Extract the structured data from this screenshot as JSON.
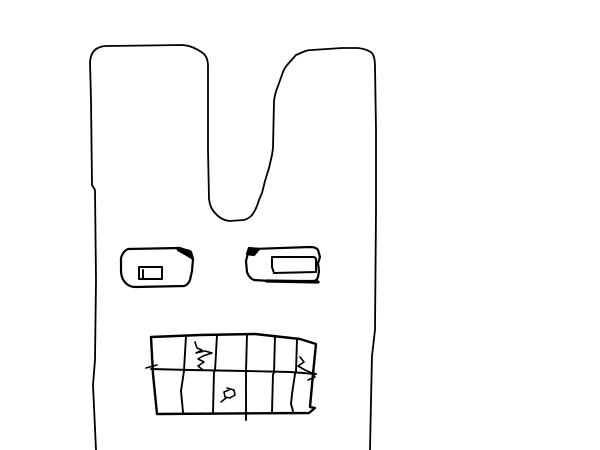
{
  "artwork": {
    "description": "Hand-drawn black-on-white paint doodle of a face with two tall ears, two rectangular eyes with folded black corners, and a gridded mouth of cracked teeth",
    "canvas": {
      "width": 600,
      "height": 450
    },
    "colors": {
      "background": "#ffffff",
      "line": "#000000"
    },
    "paths": {
      "head_outline": "M 96 450 L 93 385 L 95 360 L 96 280 L 95 190 L 92 185 L 91 100 L 90 62 Q 91 51 98 48 Q 102 46 106 46 L 183 45 L 189 46 Q 198 49 204 54 Q 208 58 208 66 L 208 150 L 209 199 Q 210 208 215 213 Q 221 220 229 221 L 244 220 Q 251 218 254 212 Q 257 207 259 200 L 262 193 L 265 181 L 269 168 L 272 155 L 273 148 L 274 101 Q 275 93 278 86 L 283 72 Q 285 67 288 64 L 296 55 L 303 52 Q 307 50 312 50 L 342 48 L 358 48 Q 367 49 372 53 Q 375 57 375 66 L 376 130 L 376 210 L 375 330 L 372 356 L 371 400 L 370 450",
      "left_eye_outline": "M 128 249 L 180 248 L 191 252 L 193 259 L 192 271 L 190 280 Q 188 285 184 286 L 136 287 Q 128 287 124 281 Q 121 277 121 270 L 121 258 Q 123 251 128 249 Z",
      "left_eye_fold": "M 177 248 L 190 251 L 193 259 L 185 254 L 178 250 Z",
      "left_eye_pupil": "M 139 267 L 162 267 L 162 279 L 139 279 Z",
      "left_eye_pupil_line": "M 143 270 L 143 279",
      "right_eye_outline": "M 252 249 L 310 247 Q 316 247 318 250 L 320 257 L 318 263 L 319 271 L 318 277 Q 317 281 313 281 L 270 281 L 254 280 Q 249 278 247 272 L 246 261 L 248 253 Q 249 250 252 249 Z",
      "right_eye_fold": "M 247 254 L 249 248 L 259 249 L 254 255 Z",
      "right_eye_pupil": "M 272 257 L 313 257 Q 316 257 316 260 L 316 272 L 274 273 L 272 267 Z",
      "right_eye_bottom_thick": "M 267 281 L 318 282",
      "mouth_outline": "M 151 337 L 200 335 L 255 334 L 300 339 L 316 344 L 313 374 L 310 407 L 315 408 L 309 413 L 157 414 L 153 374 L 151 337 Z",
      "mouth_middle_line": "M 151 369 L 190 370 L 246 371 L 290 372 L 316 374",
      "teeth_lines": "M 186 336 L 184 370 M 217 335 L 215 371 M 247 334 L 246 372 L 246 420 M 275 336 L 274 373 M 297 339 L 296 372 M 184 371 L 181 391 L 183 412 M 214 372 L 213 413 M 273 374 L 272 412 M 295 374 L 292 394 L 291 404 L 293 411",
      "crack_top_tooth": "M 195 342 L 197 348 L 202 350 L 196 353 L 205 351 L 212 353 L 203 356 L 198 359 L 204 362 L 198 366 L 203 370",
      "crack_right_tooth": "M 300 357 L 304 362 L 298 366 L 305 370 L 312 373 L 315 377 L 308 380",
      "blob_bottom_tooth": "M 227 388 L 234 390 L 235 395 L 230 398 L 225 397 L 224 392 L 229 390 M 226 398 L 221 402",
      "tick_left_edge": "M 146 368 L 157 365"
    }
  }
}
